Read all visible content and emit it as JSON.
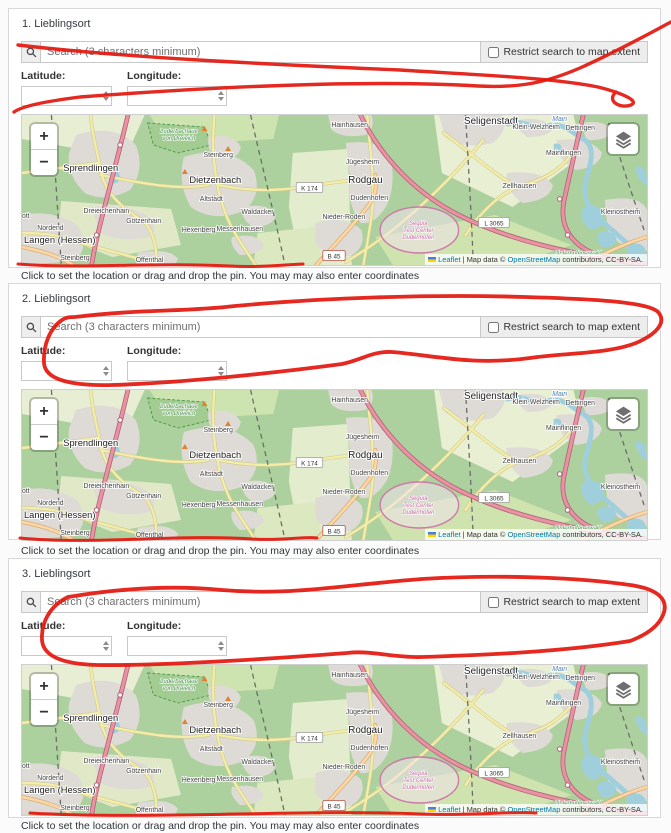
{
  "page": {
    "background": "#fbfbfb"
  },
  "colors": {
    "annotation_red": "#e3170d",
    "link_blue": "#0078A8",
    "card_border": "#d8d8d8"
  },
  "sections": [
    {
      "title": "1. Lieblingsort"
    },
    {
      "title": "2. Lieblingsort"
    },
    {
      "title": "3. Lieblingsort"
    }
  ],
  "widget": {
    "search_placeholder": "Search (3 characters minimum)",
    "search_value": "",
    "search_icon": "magnifier",
    "restrict_checkbox_label": "Restrict search to map extent",
    "restrict_checked": false,
    "latitude_label": "Latitude:",
    "longitude_label": "Longitude:",
    "latitude_value": "",
    "longitude_value": "",
    "hint": "Click to set the location or drag and drop the pin. You may may also enter coordinates",
    "zoom_in": "+",
    "zoom_out": "−"
  },
  "map": {
    "width": 637,
    "height": 150,
    "background": "#add19e",
    "attribution": {
      "flag": "ukraine-flag",
      "leaflet_label": "Leaflet",
      "divider": "|",
      "mapdata_text": "Map data ©",
      "osm_label": "OpenStreetMap",
      "suffix": "contributors, CC-BY-SA."
    },
    "badges": [
      {
        "text": "K 174",
        "x": 293,
        "y": 73,
        "kind": "k"
      },
      {
        "text": "B 45",
        "x": 318,
        "y": 141,
        "kind": "b"
      },
      {
        "text": "L 3065",
        "x": 481,
        "y": 108,
        "kind": "l"
      }
    ],
    "labels": [
      {
        "text": "Sprendlingen",
        "x": 70,
        "y": 56,
        "cls": "m-city"
      },
      {
        "text": "Dietzenbach",
        "x": 197,
        "y": 68,
        "cls": "m-city"
      },
      {
        "text": "Rodgau",
        "x": 350,
        "y": 68,
        "cls": "m-town"
      },
      {
        "text": "Seligenstadt",
        "x": 478,
        "y": 9,
        "cls": "m-town"
      },
      {
        "text": "Langen (Hessen)",
        "x": 2,
        "y": 128,
        "cls": "m-city",
        "anchor": "start"
      },
      {
        "text": "Steinberg",
        "x": 200,
        "y": 42,
        "cls": "m-suburb"
      },
      {
        "text": "Altstadt",
        "x": 193,
        "y": 86,
        "cls": "m-suburb"
      },
      {
        "text": "Dreieichenhain",
        "x": 86,
        "y": 98,
        "cls": "m-suburb"
      },
      {
        "text": "Götzenhain",
        "x": 124,
        "y": 108,
        "cls": "m-suburb"
      },
      {
        "text": "Hexenberg",
        "x": 180,
        "y": 117,
        "cls": "m-suburb"
      },
      {
        "text": "Nordend",
        "x": 29,
        "y": 115,
        "cls": "m-suburb"
      },
      {
        "text": "Steinberg",
        "x": 54,
        "y": 145,
        "cls": "m-suburb"
      },
      {
        "text": "Offenthal",
        "x": 130,
        "y": 147,
        "cls": "m-suburb"
      },
      {
        "text": "Messenhausen",
        "x": 222,
        "y": 116,
        "cls": "m-suburb"
      },
      {
        "text": "Waldacker",
        "x": 240,
        "y": 99,
        "cls": "m-suburb"
      },
      {
        "text": "Hainhausen",
        "x": 334,
        "y": 12,
        "cls": "m-suburb"
      },
      {
        "text": "Jügesheim",
        "x": 347,
        "y": 49,
        "cls": "m-suburb"
      },
      {
        "text": "Dudenhofen",
        "x": 354,
        "y": 85,
        "cls": "m-suburb"
      },
      {
        "text": "Nieder-Roden",
        "x": 328,
        "y": 104,
        "cls": "m-suburb"
      },
      {
        "text": "Klein-Welzheim",
        "x": 524,
        "y": 14,
        "cls": "m-suburb"
      },
      {
        "text": "Dettingen",
        "x": 569,
        "y": 15,
        "cls": "m-suburb"
      },
      {
        "text": "Mainflingen",
        "x": 552,
        "y": 40,
        "cls": "m-suburb"
      },
      {
        "text": "Zellhausen",
        "x": 507,
        "y": 73,
        "cls": "m-suburb"
      },
      {
        "text": "Kleinostheim",
        "x": 610,
        "y": 99,
        "cls": "m-suburb"
      },
      {
        "text": "ott",
        "x": 0,
        "y": 103,
        "cls": "m-suburb",
        "anchor": "start"
      },
      {
        "text": "Main",
        "x": 548,
        "y": 6,
        "cls": "m-water"
      },
      {
        "text": "Luderbachaue",
        "x": 160,
        "y": 18,
        "cls": "m-green"
      },
      {
        "text": "von Dreieich",
        "x": 160,
        "y": 25,
        "cls": "m-green"
      },
      {
        "text": "Unterhufenerwald",
        "x": 567,
        "y": 140,
        "cls": "m-green"
      },
      {
        "text": "Segula",
        "x": 404,
        "y": 110,
        "cls": "m-pink"
      },
      {
        "text": "Test Center",
        "x": 404,
        "y": 117,
        "cls": "m-pink"
      },
      {
        "text": "Dudenhofen",
        "x": 404,
        "y": 124,
        "cls": "m-pink"
      }
    ],
    "geometry": {
      "patches": [
        {
          "d": "M0,0 L125,0 L112,28 L58,34 L0,24 Z",
          "fill": "#e7eed3"
        },
        {
          "d": "M130,0 L262,0 L256,24 L150,30 Z",
          "fill": "#cde4b0"
        },
        {
          "d": "M40,86 L152,94 L162,130 L92,142 L36,120 Z",
          "fill": "#e0e8c8"
        },
        {
          "d": "M276,38 L332,34 L336,150 L284,150 L272,92 Z",
          "fill": "#e4ecce"
        },
        {
          "d": "M420,0 L562,0 L572,40 L500,92 L428,58 Z",
          "fill": "#e9efd2"
        },
        {
          "d": "M360,122 L482,100 L560,130 L500,150 L378,150 Z",
          "fill": "#cfe3ae"
        },
        {
          "d": "M240,118 L300,112 L306,150 L236,150 Z",
          "fill": "#dce8c0"
        }
      ],
      "reserve": {
        "d": "M128,8 L186,12 L193,30 L159,38 L134,30 Z",
        "fill": "#a2cc92",
        "stroke": "#3f8f3f"
      },
      "urban_fill": "#dedbd7",
      "urban": [
        "M55,20 Q95,8 116,30 Q126,55 110,75 Q85,88 64,78 Q45,60 48,38 Z",
        "M0,100 Q30,94 56,110 Q70,128 55,146 L0,150 Z",
        "M70,92 Q100,87 126,100 Q141,112 130,122 Q100,128 80,118 Z",
        "M165,42 Q210,28 236,55 Q246,80 226,96 Q195,108 172,92 Q158,68 165,42 Z",
        "M190,22 Q215,17 223,32 Q221,45 200,46 Q188,36 190,22 Z",
        "M225,92 Q250,87 259,100 Q256,112 235,112 Q222,103 225,92 Z",
        "M214,122 Q240,117 247,130 Q243,140 222,140 Q211,130 214,122 Z",
        "M118,138 Q150,132 159,144 L156,150 L116,150 Z",
        "M312,0 L356,0 Q361,12 350,20 Q325,24 315,14 Z",
        "M330,28 Q369,23 376,45 Q381,70 372,90 Q360,110 345,108 Q331,90 334,60 Z",
        "M299,108 Q330,99 346,115 Q351,132 335,141 Q309,143 299,128 Z",
        "M425,0 L491,0 Q496,15 480,28 Q450,35 431,22 Z",
        "M505,5 Q530,1 541,12 Q539,22 515,22 Q504,15 505,5 Z",
        "M545,25 Q580,21 591,38 Q589,52 565,55 Q544,45 545,25 Z",
        "M494,58 Q530,54 541,70 Q539,85 510,88 Q492,75 494,58 Z",
        "M594,85 Q630,79 637,95 L637,136 Q610,136 597,115 Z",
        "M570,8 Q595,4 601,16 Q598,26 575,25 Z"
      ],
      "river": {
        "d": "M495,9 C510,3 518,15 535,11 C552,7 558,16 572,24 C585,31 580,48 575,65 C570,82 578,95 592,107 C606,119 620,131 630,140 C634,144 637,147 637,149",
        "color": "#9fcfdd",
        "w": 5
      },
      "lakes": [
        "M572,92 Q588,87 593,100 Q595,112 580,115 Q567,106 572,92",
        "M588,118 Q601,113 606,124 Q604,133 592,132 Q584,126 588,118",
        "M618,130 Q632,125 636,136 Q634,146 622,144 Q613,138 618,130",
        "M625,52 Q637,48 637,70 Q627,66 625,52",
        "M542,29 Q549,27 550,33 Q548,38 542,36 Z",
        "M92,56 Q99,54 100,62 Q98,70 92,68 Z"
      ],
      "yellow": {
        "color": "#f3eda9",
        "casing": "#cfc98f",
        "w": 2.4,
        "paths": [
          "M70,0 C72,25 78,40 80,55 C85,80 105,95 122,105 C132,112 138,130 137,150",
          "M0,58 L78,48",
          "M80,60 C130,70 160,75 190,70",
          "M196,48 C198,70 202,85 208,100 C215,118 228,135 238,150",
          "M200,70 C240,78 270,75 300,70 C320,67 335,65 352,64",
          "M352,0 C354,30 358,55 358,75 C358,100 352,125 348,150",
          "M0,118 C30,118 45,122 60,128 C90,136 112,142 137,148",
          "M470,25 C450,50 420,80 390,105 C370,122 350,135 330,147",
          "M430,18 C460,40 482,60 505,72",
          "M560,40 C545,58 530,65 505,72 C485,80 465,100 452,120",
          "M196,48 C194,30 195,15 196,0"
        ]
      },
      "orange": {
        "color": "#fcd6a4",
        "casing": "#d0a46a",
        "w": 2.8,
        "paths": [
          "M300,150 C320,128 340,108 355,88 C360,80 362,70 360,60",
          "M570,150 C595,138 615,128 637,122",
          "M0,132 C20,136 38,141 52,150"
        ]
      },
      "motorway": {
        "color": "#e892a2",
        "casing": "#b05f77",
        "w": 3.2,
        "paths": [
          "M108,0 C102,25 94,55 86,85 C80,108 74,130 71,150",
          "M345,0 C362,35 395,75 445,100 C495,125 560,140 637,149",
          "M572,0 C565,30 558,60 552,88 C548,112 560,132 592,142 C612,147 626,149 637,149"
        ]
      },
      "rail": {
        "color": "#6b6b6b",
        "w": 1.3,
        "dash": "5,4",
        "paths": [
          "M30,0 L40,150",
          "M233,0 C242,40 255,90 268,150",
          "M452,0 C455,50 458,100 460,150",
          "M598,8 C610,45 622,80 634,115"
        ]
      },
      "track": {
        "cx": 405,
        "cy": 115,
        "rx": 40,
        "ry": 23,
        "stroke": "#cc7aa8",
        "fill": "#f0e3ec"
      },
      "junctions": [
        [
          100,
          30
        ],
        [
          76,
          120
        ],
        [
          548,
          84
        ],
        [
          556,
          120
        ],
        [
          600,
          144
        ]
      ],
      "peaks": [
        [
          186,
          14
        ],
        [
          166,
          57
        ],
        [
          210,
          34
        ],
        [
          196,
          83
        ]
      ]
    }
  },
  "annotations": {
    "paths": [
      {
        "d": "M18,45 C120,57 260,64 400,70 C480,75 555,78 598,87 C622,93 640,101 631,105 C620,109 606,101 616,92",
        "w": 3.4
      },
      {
        "d": "M671,22 C652,32 620,50 580,68 C545,83 520,88 478,86 C360,79 200,88 80,97 C48,101 22,106 14,112",
        "w": 3.4
      },
      {
        "d": "M18,264 C80,269 150,262 230,266 C265,268 292,264 303,264",
        "w": 3
      },
      {
        "d": "M75,317 C140,309 185,312 235,306 C320,298 430,294 525,297 C595,299 648,302 658,312 C667,322 657,334 636,343 C608,354 562,353 530,358 C472,366 432,355 392,352 C372,351 362,360 342,364 C282,372 182,383 112,385 C72,386 45,380 44,363 C43,345 50,328 62,320 C66,317 71,317 75,317",
        "w": 3.8
      },
      {
        "d": "M20,538 C90,545 180,534 252,539 C283,541 307,536 317,538",
        "w": 3
      },
      {
        "d": "M68,597 C122,588 172,585 222,590 C292,596 342,585 422,579 C502,574 582,578 630,585 C660,589 669,601 663,615 C658,627 646,635 630,641 C562,652 482,655 422,657 C392,658 372,650 347,653 C282,658 162,666 97,665 C62,664 43,656 42,640 C41,622 50,606 68,597",
        "w": 3.8
      },
      {
        "d": "M30,813 C150,820 300,809 420,814 C470,816 512,811 536,813",
        "w": 3
      }
    ]
  }
}
